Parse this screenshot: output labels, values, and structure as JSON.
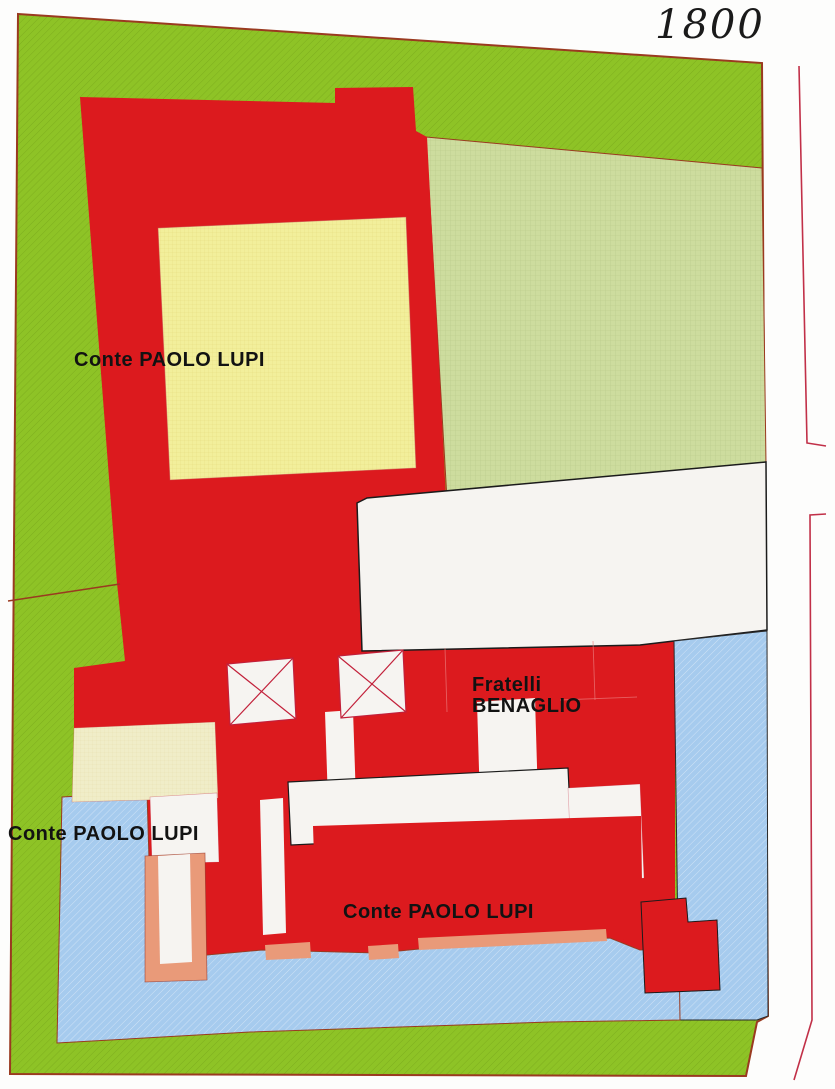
{
  "title": "1800",
  "labels": {
    "upper_owner": "Conte PAOLO LUPI",
    "middle_owner_line1": "Fratelli",
    "middle_owner_line2": "BENAGLIO",
    "left_owner": "Conte PAOLO LUPI",
    "bottom_owner": "Conte PAOLO LUPI"
  },
  "colors": {
    "green": "#8ec326",
    "pale_green": "#cddc9e",
    "red": "#dc1a1e",
    "yellow": "#f2ef9b",
    "cream": "#f0edc8",
    "blue": "#a6cbee",
    "white_region": "#f6f4f1",
    "salmon": "#e99a79",
    "outline": "#9a3a20",
    "parcel_line": "#c2203a",
    "black_line": "#1b1b1b",
    "bracket": "#c13048"
  }
}
